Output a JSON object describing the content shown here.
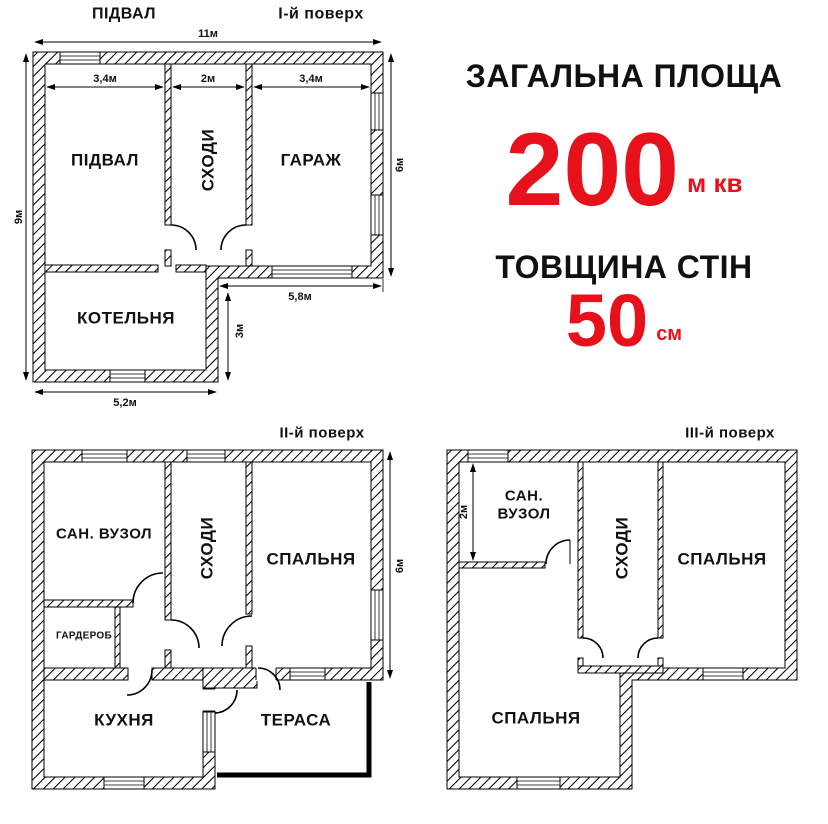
{
  "colors": {
    "accent_red": "#e6111b",
    "line_black": "#111111"
  },
  "info": {
    "area_label": "ЗАГАЛЬНА ПЛОЩА",
    "area_value": "200",
    "area_unit": "м кв",
    "thickness_label": "ТОВЩИНА СТІН",
    "thickness_value": "50",
    "thickness_unit": "см"
  },
  "plan1": {
    "title_left": "ПІДВАЛ",
    "title_right": "І-й поверх",
    "rooms": {
      "basement": "ПІДВАЛ",
      "stairs": "СХОДИ",
      "garage": "ГАРАЖ",
      "boiler": "КОТЕЛЬНЯ"
    },
    "dims": {
      "total_width": "11м",
      "basement_width": "3,4м",
      "stairs_width": "2м",
      "garage_width": "3,4м",
      "left_height": "9м",
      "right_height": "6м",
      "bottom_right_width": "5,8м",
      "ext_height": "3м",
      "ext_width": "5,2м"
    }
  },
  "plan2": {
    "title": "ІІ-й поверх",
    "rooms": {
      "bathroom": "САН. ВУЗОЛ",
      "stairs": "СХОДИ",
      "bedroom": "СПАЛЬНЯ",
      "wardrobe": "ГАРДЕРОБ",
      "kitchen": "КУХНЯ",
      "terrace": "ТЕРАСА"
    },
    "dims": {
      "right_height": "6м"
    }
  },
  "plan3": {
    "title": "ІІІ-й поверх",
    "rooms": {
      "bathroom_line1": "САН.",
      "bathroom_line2": "ВУЗОЛ",
      "stairs": "СХОДИ",
      "bedroom_right": "СПАЛЬНЯ",
      "bedroom_bottom": "СПАЛЬНЯ"
    },
    "dims": {
      "bathroom_height": "2м"
    }
  }
}
